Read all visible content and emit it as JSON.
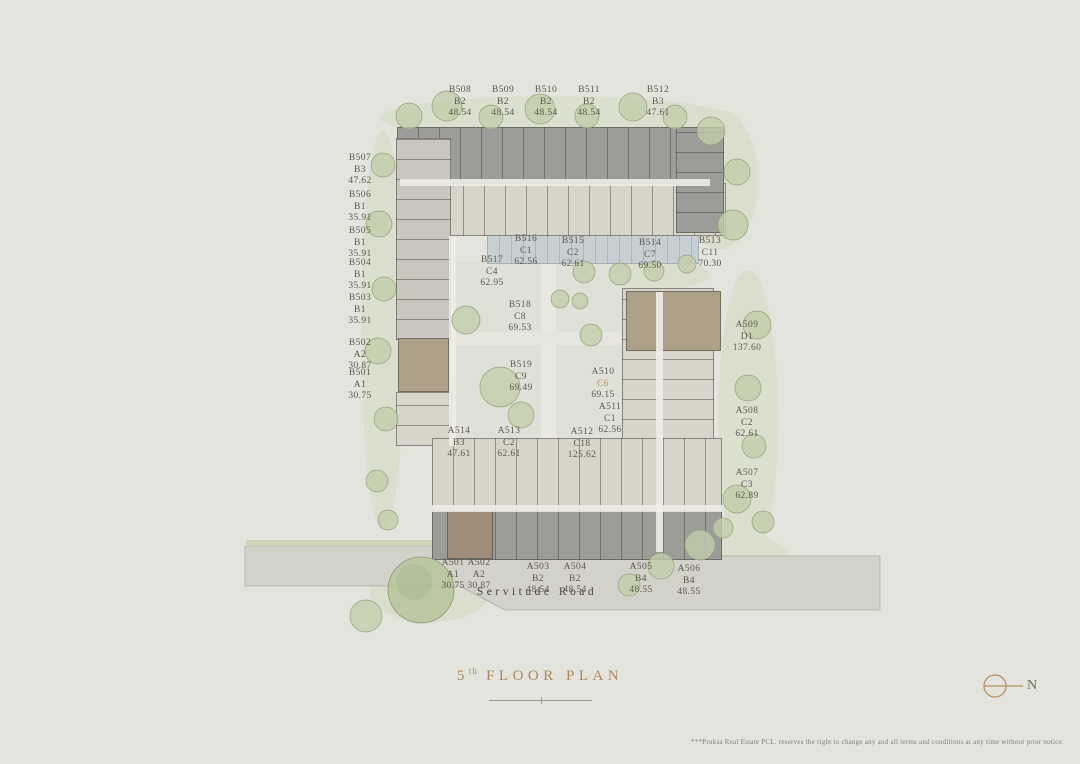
{
  "page": {
    "background": "#e4e4df"
  },
  "plan": {
    "title": {
      "number": "5",
      "ordinal": "th",
      "text": "FLOOR PLAN"
    },
    "north_label": "N",
    "road_label": "Servitude Road",
    "disclaimer": "***Pruksa Real Estate PCL. reserves the right to change any and all terms and conditions at any time without prior notice."
  },
  "colors": {
    "title_gold": "#aa8a5c",
    "label_text": "#5d594e",
    "highlight_type": "#b0955f",
    "building_dark": "#9c9c99",
    "building_light": "#d7d4ca",
    "building_brown": "#aca089",
    "pool": "#c6d0d3",
    "tree": "#c2cdaa",
    "road": "#d2d1ca"
  },
  "units": [
    {
      "unit": "B508",
      "type": "B2",
      "area": "48.54",
      "x": 460,
      "y": 85
    },
    {
      "unit": "B509",
      "type": "B2",
      "area": "48.54",
      "x": 503,
      "y": 85
    },
    {
      "unit": "B510",
      "type": "B2",
      "area": "48.54",
      "x": 546,
      "y": 85
    },
    {
      "unit": "B511",
      "type": "B2",
      "area": "48.54",
      "x": 589,
      "y": 85
    },
    {
      "unit": "B512",
      "type": "B3",
      "area": "47.61",
      "x": 658,
      "y": 85
    },
    {
      "unit": "B507",
      "type": "B3",
      "area": "47.62",
      "x": 360,
      "y": 153
    },
    {
      "unit": "B506",
      "type": "B1",
      "area": "35.91",
      "x": 360,
      "y": 190
    },
    {
      "unit": "B505",
      "type": "B1",
      "area": "35.91",
      "x": 360,
      "y": 226
    },
    {
      "unit": "B504",
      "type": "B1",
      "area": "35.91",
      "x": 360,
      "y": 258
    },
    {
      "unit": "B503",
      "type": "B1",
      "area": "35.91",
      "x": 360,
      "y": 293
    },
    {
      "unit": "B502",
      "type": "A2",
      "area": "30.87",
      "x": 360,
      "y": 338
    },
    {
      "unit": "B501",
      "type": "A1",
      "area": "30.75",
      "x": 360,
      "y": 368
    },
    {
      "unit": "B516",
      "type": "C1",
      "area": "62.56",
      "x": 526,
      "y": 234
    },
    {
      "unit": "B515",
      "type": "C2",
      "area": "62.61",
      "x": 573,
      "y": 236
    },
    {
      "unit": "B514",
      "type": "C7",
      "area": "69.50",
      "x": 650,
      "y": 238
    },
    {
      "unit": "B513",
      "type": "C11",
      "area": "70.30",
      "x": 710,
      "y": 236
    },
    {
      "unit": "B517",
      "type": "C4",
      "area": "62.95",
      "x": 492,
      "y": 255
    },
    {
      "unit": "B518",
      "type": "C8",
      "area": "69.53",
      "x": 520,
      "y": 300
    },
    {
      "unit": "B519",
      "type": "C9",
      "area": "69.49",
      "x": 521,
      "y": 360
    },
    {
      "unit": "A510",
      "type": "C6",
      "area": "69.15",
      "x": 603,
      "y": 367,
      "type_color": "#b0955f"
    },
    {
      "unit": "A511",
      "type": "C1",
      "area": "62.56",
      "x": 610,
      "y": 402
    },
    {
      "unit": "A512",
      "type": "C18",
      "area": "125.62",
      "x": 582,
      "y": 427
    },
    {
      "unit": "A513",
      "type": "C2",
      "area": "62.61",
      "x": 509,
      "y": 426
    },
    {
      "unit": "A514",
      "type": "B3",
      "area": "47.61",
      "x": 459,
      "y": 426
    },
    {
      "unit": "A509",
      "type": "D1",
      "area": "137.60",
      "x": 747,
      "y": 320
    },
    {
      "unit": "A508",
      "type": "C2",
      "area": "62.61",
      "x": 747,
      "y": 406
    },
    {
      "unit": "A507",
      "type": "C3",
      "area": "62.89",
      "x": 747,
      "y": 468
    },
    {
      "unit": "A501",
      "type": "A1",
      "area": "30.75",
      "x": 453,
      "y": 558
    },
    {
      "unit": "A502",
      "type": "A2",
      "area": "30.87",
      "x": 479,
      "y": 558
    },
    {
      "unit": "A503",
      "type": "B2",
      "area": "48.54",
      "x": 538,
      "y": 562
    },
    {
      "unit": "A504",
      "type": "B2",
      "area": "48.54",
      "x": 575,
      "y": 562
    },
    {
      "unit": "A505",
      "type": "B4",
      "area": "48.55",
      "x": 641,
      "y": 562
    },
    {
      "unit": "A506",
      "type": "B4",
      "area": "48.55",
      "x": 689,
      "y": 564
    }
  ]
}
